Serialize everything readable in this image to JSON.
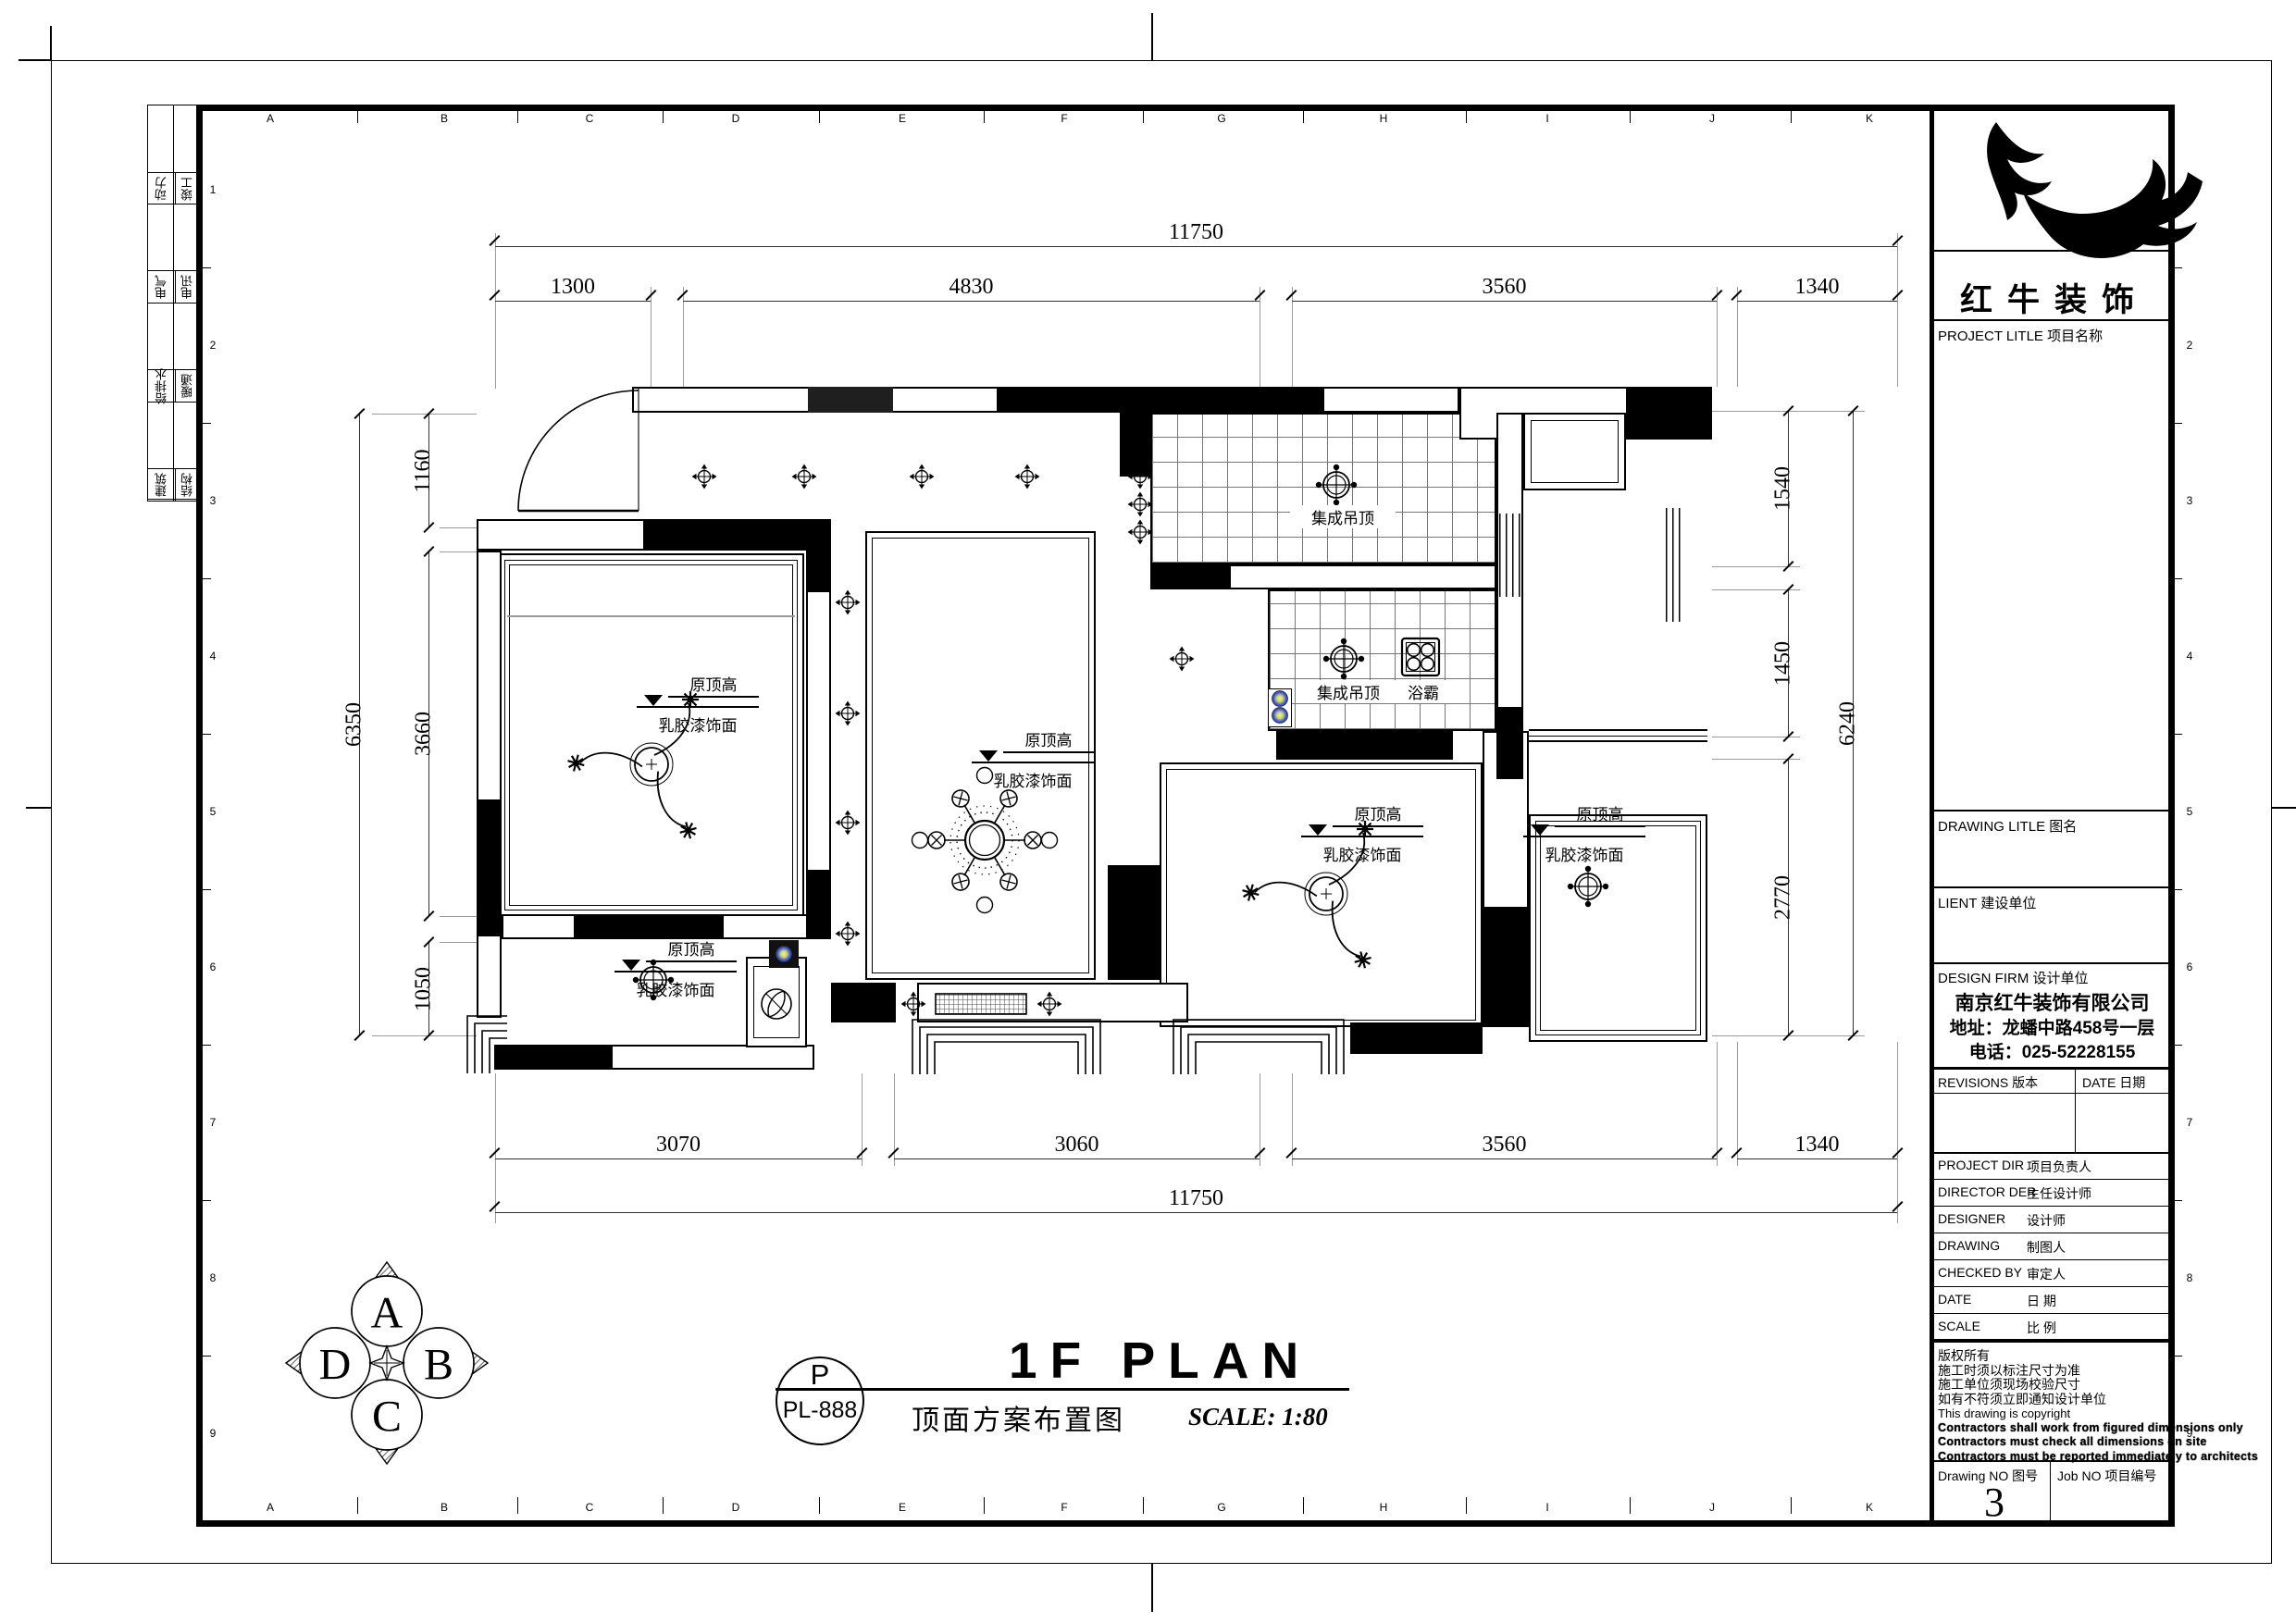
{
  "brand": {
    "name": "红牛装饰"
  },
  "sign_strip": {
    "rows": [
      {
        "l": "动力",
        "r": "竣工"
      },
      {
        "l": "电气",
        "r": "电讯"
      },
      {
        "l": "给排水",
        "r": "暖通"
      },
      {
        "l": "建筑",
        "r": "结构"
      }
    ]
  },
  "grid": {
    "letters": [
      "A",
      "B",
      "C",
      "D",
      "E",
      "F",
      "G",
      "H",
      "I",
      "J",
      "K"
    ],
    "numbers": [
      "1",
      "2",
      "3",
      "4",
      "5",
      "6",
      "7",
      "8",
      "9"
    ]
  },
  "dims": {
    "top": {
      "overall": "11750",
      "segments": [
        "1300",
        "4830",
        "3560",
        "1340"
      ]
    },
    "bottom": {
      "overall": "11750",
      "segments": [
        "3070",
        "3060",
        "3560",
        "1340"
      ]
    },
    "left": {
      "overall": "6350",
      "segments": [
        "1160",
        "3660",
        "1050"
      ]
    },
    "right": {
      "overall": "6240",
      "segments": [
        "1540",
        "1450",
        "2770"
      ]
    }
  },
  "plan": {
    "kitchen_ceiling": "集成吊顶",
    "bath_ceiling": "集成吊顶",
    "bath_heater": "浴霸",
    "elev_top": "原顶高",
    "elev_bottom": "乳胶漆饰面"
  },
  "footer": {
    "badge_top": "P",
    "badge_bottom": "PL-888",
    "title": "1F PLAN",
    "subtitle": "顶面方案布置图",
    "scale": "SCALE: 1:80"
  },
  "compass": {
    "n": "A",
    "e": "B",
    "s": "C",
    "w": "D"
  },
  "title_block": {
    "project_title": "PROJECT LITLE  项目名称",
    "drawing_title": "DRAWING LITLE  图名",
    "client": "LIENT  建设单位",
    "design_firm": "DESIGN FIRM  设计单位",
    "company": "南京红牛装饰有限公司",
    "address": "地址：龙蟠中路458号一层",
    "phone": "电话：025-52228155",
    "revisions": "REVISIONS  版本",
    "date_col": "DATE  日期",
    "rows": [
      {
        "en": "PROJECT DIR",
        "cn": "项目负责人"
      },
      {
        "en": "DIRECTOR DER",
        "cn": "主任设计师"
      },
      {
        "en": "DESIGNER",
        "cn": "设计师"
      },
      {
        "en": "DRAWING",
        "cn": "制图人"
      },
      {
        "en": "CHECKED BY",
        "cn": "审定人"
      },
      {
        "en": "DATE",
        "cn": "日  期"
      },
      {
        "en": "SCALE",
        "cn": "比  例"
      }
    ],
    "copyright": [
      "版权所有",
      "施工时须以标注尺寸为准",
      "施工单位须现场校验尺寸",
      "如有不符须立即通知设计单位",
      "This drawing is copyright",
      "Contractors shall work from figured dimensions only",
      "Contractors must check all dimensions on site",
      "Contractors must be reported immediately to architects",
      "This drawing is copyright"
    ],
    "drawing_no_label": "Drawing NO  图号",
    "drawing_no": "3",
    "job_no_label": "Job NO  项目编号"
  }
}
